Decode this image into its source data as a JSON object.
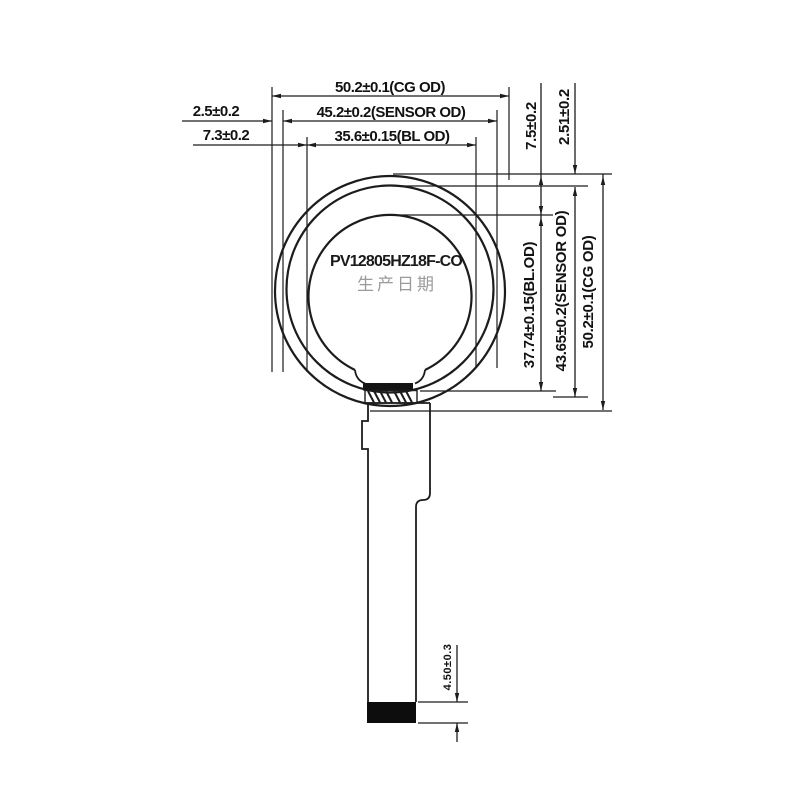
{
  "labels": {
    "part_number": "PV12805HZ18F-CO",
    "production_date": "生产日期"
  },
  "dimensions": {
    "top": {
      "cg_od": "50.2±0.1(CG OD)",
      "sensor_od": "45.2±0.2(SENSOR OD)",
      "bl_od": "35.6±0.15(BL OD)",
      "cg_sensor_gap": "2.5±0.2",
      "cg_bl_gap": "7.3±0.2"
    },
    "right": {
      "cg_bl_top_gap": "7.5±0.2",
      "cg_sensor_top_gap": "2.51±0.2",
      "bl_od_vertical": "37.74±0.15(BL.OD)",
      "sensor_od_vertical": "43.65±0.2(SENSOR OD)",
      "cg_od_vertical": "50.2±0.1(CG OD)"
    },
    "bottom": {
      "connector_height": "4.50±0.3"
    }
  },
  "colors": {
    "line": "#1c1c1c",
    "date_text": "#9a9a9a",
    "background": "#ffffff"
  }
}
